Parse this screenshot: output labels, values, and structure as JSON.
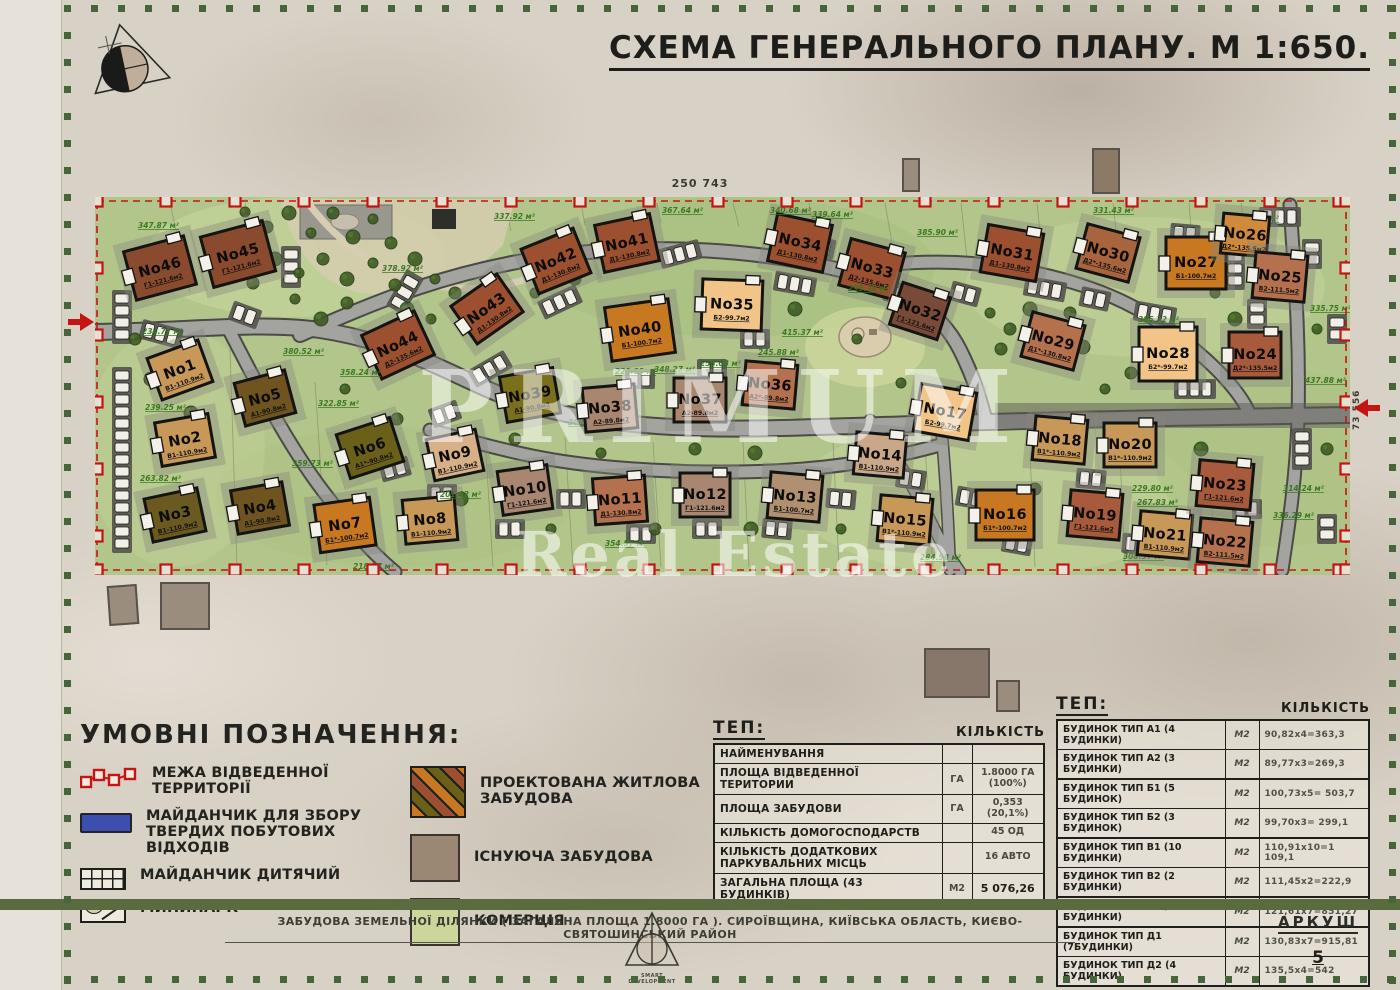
{
  "title": "СХЕМА ГЕНЕРАЛЬНОГО ПЛАНУ. М 1:650.",
  "dimensions": {
    "top": "250 743",
    "right": "73 556"
  },
  "watermark": {
    "line1": "PRIMUM",
    "line2": "Real Estate"
  },
  "legend": {
    "heading": "УМОВНІ ПОЗНАЧЕННЯ:",
    "items": [
      {
        "id": "boundary",
        "label": "МЕЖА ВІДВЕДЕННОЇ ТЕРРИТОРІЇ"
      },
      {
        "id": "waste",
        "label": "МАЙДАНЧИК ДЛЯ ЗБОРУ ТВЕРДИХ ПОБУТОВИХ ВІДХОДІВ"
      },
      {
        "id": "playground",
        "label": "МАЙДАНЧИК ДИТЯЧИЙ"
      },
      {
        "id": "minipark",
        "label": "МИНИПАРК"
      },
      {
        "id": "projected",
        "label": "ПРОЕКТОВАНА ЖИТЛОВА ЗАБУДОВА"
      },
      {
        "id": "existing",
        "label": "ІСНУЮЧА ЗАБУДОВА"
      },
      {
        "id": "commerce",
        "label": "КОМЕРЦІЯ"
      }
    ]
  },
  "tep_main": {
    "heading": "ТЕП:",
    "qty_header": "КІЛЬКІСТЬ",
    "rows": [
      {
        "name": "НАЙМЕНУВАННЯ",
        "unit": "",
        "qty": ""
      },
      {
        "name": "ПЛОЩА ВІДВЕДЕННОЇ ТЕРИТОРИИ",
        "unit": "ГА",
        "qty": "1.8000 ГА\n(100%)"
      },
      {
        "name": "ПЛОЩА ЗАБУДОВИ",
        "unit": "ГА",
        "qty": "0,353\n(20,1%)"
      },
      {
        "name": "КІЛЬКІСТЬ ДОМОГОСПОДАРСТВ",
        "unit": "",
        "qty": "45 ОД"
      },
      {
        "name": "КІЛЬКІСТЬ ДОДАТКОВИХ ПАРКУВАЛЬНИХ МІСЦЬ",
        "unit": "",
        "qty": "16 АВТО"
      },
      {
        "name": "ЗАГАЛЬНА ПЛОЩА (43 БУДИНКІВ)",
        "unit": "М2",
        "qty": "5 076,26"
      }
    ]
  },
  "tep_types": {
    "heading": "ТЕП:",
    "qty_header": "КІЛЬКІСТЬ",
    "rows": [
      {
        "name": "БУДИНОК ТИП А1 (4 БУДИНКИ)",
        "unit": "М2",
        "qty": "90,82х4=363,3",
        "grp": false
      },
      {
        "name": "БУДИНОК ТИП А2 (3 БУДИНКИ)",
        "unit": "М2",
        "qty": "89,77х3=269,3",
        "grp": true
      },
      {
        "name": "БУДИНОК ТИП Б1 (5 БУДИНОК)",
        "unit": "М2",
        "qty": "100,73х5= 503,7",
        "grp": false
      },
      {
        "name": "БУДИНОК ТИП Б2 (3 БУДИНОК)",
        "unit": "М2",
        "qty": "99,70х3= 299,1",
        "grp": true
      },
      {
        "name": "БУДИНОК ТИП В1 (10 БУДИНКИ)",
        "unit": "М2",
        "qty": "110,91х10=1 109,1",
        "grp": false
      },
      {
        "name": "БУДИНОК ТИП В2 (2 БУДИНКИ)",
        "unit": "М2",
        "qty": "111,45х2=222,9",
        "grp": true
      },
      {
        "name": "БУДИНОК ТИП Г1 (7 БУДИНКИ)",
        "unit": "М2",
        "qty": "121,61х7=851,27",
        "grp": true
      },
      {
        "name": "БУДИНОК ТИП Д1 (7БУДИНКИ)",
        "unit": "М2",
        "qty": "130,83х7=915,81",
        "grp": false
      },
      {
        "name": "БУДИНОК ТИП Д2 (4 БУДИНКИ)",
        "unit": "М2",
        "qty": "135,5х4=542",
        "grp": true
      }
    ]
  },
  "footer": {
    "project": "ЗАБУДОВА ЗЕМЕЛЬНОЇ ДІЛЯНКИ ( ЗАГАЛЬНА ПЛОЩА 1.8000 ГА ). СИРОЇВЩИНА, КИЇВСЬКА ОБЛАСТЬ, КИЄВО-СВЯТОШИНСЬКИЙ РАЙОН",
    "logo_caption": "SMART DEVELOPMENT",
    "sheet_label": "АРКУШ",
    "sheet_number": "5"
  },
  "map": {
    "boundary_color": "#c41414",
    "plots": [
      {
        "n": "No46",
        "t": "Г1-121.6м2",
        "c": "#8a4a2e",
        "x": 65,
        "y": 71,
        "w": 62,
        "h": 50,
        "r": -15,
        "a": "347.87 м²",
        "ax": -22,
        "ay": -40
      },
      {
        "n": "No45",
        "t": "Г1-121.6м2",
        "c": "#8a4a2e",
        "x": 143,
        "y": 57,
        "w": 64,
        "h": 52,
        "r": -15
      },
      {
        "n": "No44",
        "t": "Д2-135.6м2",
        "c": "#9c5030",
        "x": 303,
        "y": 148,
        "w": 58,
        "h": 48,
        "r": -25,
        "a": "358.24 м²",
        "ax": -58,
        "ay": 30
      },
      {
        "n": "No43",
        "t": "Д1-130.8м2",
        "c": "#9c5030",
        "x": 392,
        "y": 112,
        "w": 56,
        "h": 46,
        "r": -35,
        "a": "378.92 м²",
        "ax": -105,
        "ay": -38
      },
      {
        "n": "No42",
        "t": "Д1-130.8м2",
        "c": "#9c5030",
        "x": 461,
        "y": 64,
        "w": 56,
        "h": 48,
        "r": -22,
        "a": "337.92 м²",
        "ax": -62,
        "ay": -42
      },
      {
        "n": "No41",
        "t": "Д1-130.8м2",
        "c": "#9c5030",
        "x": 532,
        "y": 46,
        "w": 56,
        "h": 48,
        "r": -12,
        "a": "367.64 м²",
        "ax": 35,
        "ay": -30
      },
      {
        "n": "No40",
        "t": "Б1-100.7м2",
        "c": "#c87820",
        "x": 545,
        "y": 133,
        "w": 64,
        "h": 54,
        "r": -8,
        "a": "348.27 м²",
        "ax": 14,
        "ay": 42
      },
      {
        "n": "No35",
        "t": "Б2-99.7м2",
        "c": "#f2c488",
        "x": 637,
        "y": 108,
        "w": 60,
        "h": 50,
        "r": 2,
        "a": "415.37 м²",
        "ax": 50,
        "ay": 30
      },
      {
        "n": "No34",
        "t": "Д1-130.8м2",
        "c": "#9c5030",
        "x": 705,
        "y": 46,
        "w": 56,
        "h": 48,
        "r": 12,
        "a": "340.68 м²",
        "ax": -30,
        "ay": -30
      },
      {
        "n": "No33",
        "t": "Д2-135.6м2",
        "c": "#9c5030",
        "x": 777,
        "y": 72,
        "w": 56,
        "h": 48,
        "r": 15,
        "a": "339.64 м²",
        "ax": -60,
        "ay": -52
      },
      {
        "n": "No32",
        "t": "Г1-121.6м2",
        "c": "#7a4a38",
        "x": 825,
        "y": 114,
        "w": 50,
        "h": 44,
        "r": 18,
        "a": "295.38 м²",
        "ax": -72,
        "ay": -20
      },
      {
        "n": "No31",
        "t": "Д1-130.8м2",
        "c": "#9c5030",
        "x": 917,
        "y": 56,
        "w": 56,
        "h": 48,
        "r": 10,
        "a": "385.90 м²",
        "ax": -95,
        "ay": -18
      },
      {
        "n": "No30",
        "t": "Д2*-135.6м2",
        "c": "#a8643c",
        "x": 1013,
        "y": 56,
        "w": 54,
        "h": 46,
        "r": 15,
        "a": "331.43 м²",
        "ax": -15,
        "ay": -40
      },
      {
        "n": "No29",
        "t": "Д1*-130.8м2",
        "c": "#b5714e",
        "x": 958,
        "y": 144,
        "w": 54,
        "h": 46,
        "r": 15
      },
      {
        "n": "No28",
        "t": "Б2*-99.7м2",
        "c": "#f2c488",
        "x": 1073,
        "y": 157,
        "w": 58,
        "h": 54,
        "r": 0,
        "a": "385.72 м²",
        "ax": -30,
        "ay": -32
      },
      {
        "n": "No27",
        "t": "Б1-100.7м2",
        "c": "#c87820",
        "x": 1101,
        "y": 66,
        "w": 60,
        "h": 52,
        "r": 0,
        "a": "311.36 м²",
        "ax": 42,
        "ay": -42
      },
      {
        "n": "No26",
        "t": "Д2*-135.5м2",
        "c": "#d08a3c",
        "x": 1150,
        "y": 38,
        "w": 46,
        "h": 40,
        "r": 5
      },
      {
        "n": "No25",
        "t": "В2-111.5м2",
        "c": "#b5714e",
        "x": 1185,
        "y": 80,
        "w": 52,
        "h": 46,
        "r": 5,
        "a": "335.75 м²",
        "ax": 30,
        "ay": 34
      },
      {
        "n": "No24",
        "t": "Д2*-135.5м2",
        "c": "#a85a3c",
        "x": 1160,
        "y": 158,
        "w": 52,
        "h": 46,
        "r": 0,
        "a": "437.88 м²",
        "ax": 50,
        "ay": 28
      },
      {
        "n": "No1",
        "t": "В1-110.9м2",
        "c": "#c89858",
        "x": 85,
        "y": 173,
        "w": 54,
        "h": 44,
        "r": -20,
        "a": "234.77 м²",
        "ax": -38,
        "ay": -36
      },
      {
        "n": "No5",
        "t": "А1-90.8м2",
        "c": "#6f5420",
        "x": 170,
        "y": 201,
        "w": 52,
        "h": 44,
        "r": -15,
        "a": "380.52 м²",
        "ax": 18,
        "ay": -44
      },
      {
        "n": "No2",
        "t": "В1-110.9м2",
        "c": "#c89858",
        "x": 90,
        "y": 243,
        "w": 54,
        "h": 44,
        "r": -10,
        "a": "239.25 м²",
        "ax": -40,
        "ay": -30
      },
      {
        "n": "No6",
        "t": "А1*-90.8м2",
        "c": "#6b6018",
        "x": 275,
        "y": 251,
        "w": 56,
        "h": 46,
        "r": -18,
        "a": "322.85 м²",
        "ax": -52,
        "ay": -42
      },
      {
        "n": "No3",
        "t": "В1-110.9м2",
        "c": "#6b5a20",
        "x": 80,
        "y": 318,
        "w": 54,
        "h": 44,
        "r": -12,
        "a": "263.82 м²",
        "ax": -35,
        "ay": -34
      },
      {
        "n": "No4",
        "t": "А1-90.8м2",
        "c": "#6f5420",
        "x": 165,
        "y": 311,
        "w": 52,
        "h": 44,
        "r": -10,
        "a": "359.73 м²",
        "ax": 32,
        "ay": -42
      },
      {
        "n": "No7",
        "t": "Б1*-100.7м2",
        "c": "#c87820",
        "x": 250,
        "y": 328,
        "w": 56,
        "h": 48,
        "r": -8,
        "a": "218.77 м²",
        "ax": 8,
        "ay": 44
      },
      {
        "n": "No8",
        "t": "В1-110.9м2",
        "c": "#c89858",
        "x": 335,
        "y": 323,
        "w": 52,
        "h": 44,
        "r": -5
      },
      {
        "n": "No9",
        "t": "В1-110.9м2",
        "c": "#d8b088",
        "x": 360,
        "y": 258,
        "w": 50,
        "h": 42,
        "r": -12,
        "a": "201.42 м²",
        "ax": -15,
        "ay": 42
      },
      {
        "n": "No39",
        "t": "А1-90.8м2",
        "c": "#7a701c",
        "x": 435,
        "y": 198,
        "w": 54,
        "h": 46,
        "r": -10,
        "a": "308.90 м²",
        "ax": 38,
        "ay": 30
      },
      {
        "n": "No10",
        "t": "Г1-121.6м2",
        "c": "#a88670",
        "x": 430,
        "y": 293,
        "w": 50,
        "h": 44,
        "r": -8
      },
      {
        "n": "No38",
        "t": "А2-89.8м2",
        "c": "#a88670",
        "x": 515,
        "y": 211,
        "w": 52,
        "h": 44,
        "r": -5,
        "a": "229.83 м²",
        "ax": 5,
        "ay": -34
      },
      {
        "n": "No11",
        "t": "Д1-130.8м2",
        "c": "#b5714e",
        "x": 525,
        "y": 303,
        "w": 52,
        "h": 46,
        "r": -4,
        "a": "354.57 м²",
        "ax": -15,
        "ay": 46
      },
      {
        "n": "No37",
        "t": "А2-89.8м2",
        "c": "#a88670",
        "x": 605,
        "y": 203,
        "w": 52,
        "h": 44,
        "r": 0,
        "a": "258.03 м²",
        "ax": 0,
        "ay": -34
      },
      {
        "n": "No12",
        "t": "Г1-121.6м2",
        "c": "#a88670",
        "x": 610,
        "y": 298,
        "w": 50,
        "h": 44,
        "r": 0
      },
      {
        "n": "No36",
        "t": "А2*-89.8м2",
        "c": "#b5714e",
        "x": 675,
        "y": 188,
        "w": 52,
        "h": 44,
        "r": 5,
        "a": "245.88 м²",
        "ax": -12,
        "ay": -30
      },
      {
        "n": "No13",
        "t": "Б1-100.7м2",
        "c": "#b09070",
        "x": 700,
        "y": 300,
        "w": 52,
        "h": 46,
        "r": 5
      },
      {
        "n": "No14",
        "t": "В1-110.9м2",
        "c": "#c8a888",
        "x": 785,
        "y": 258,
        "w": 50,
        "h": 42,
        "r": 5
      },
      {
        "n": "No17",
        "t": "Б2-99.7м2",
        "c": "#f2c488",
        "x": 850,
        "y": 215,
        "w": 56,
        "h": 48,
        "r": 10
      },
      {
        "n": "No15",
        "t": "В1*-110.9м2",
        "c": "#c89858",
        "x": 810,
        "y": 323,
        "w": 52,
        "h": 46,
        "r": 5,
        "a": "284.58 м²",
        "ax": 15,
        "ay": 40
      },
      {
        "n": "No16",
        "t": "Б1*-100.7м2",
        "c": "#c87820",
        "x": 910,
        "y": 318,
        "w": 58,
        "h": 50,
        "r": 0
      },
      {
        "n": "No18",
        "t": "В1*-110.9м2",
        "c": "#c89858",
        "x": 965,
        "y": 243,
        "w": 52,
        "h": 44,
        "r": 5,
        "a": "251.05 м²",
        "ax": 48,
        "ay": 8
      },
      {
        "n": "No19",
        "t": "Г1-121.6м2",
        "c": "#a85a3c",
        "x": 1000,
        "y": 318,
        "w": 52,
        "h": 46,
        "r": 5,
        "a": "308.37 м²",
        "ax": 28,
        "ay": 44
      },
      {
        "n": "No20",
        "t": "В1*-110.9м2",
        "c": "#c89858",
        "x": 1035,
        "y": 248,
        "w": 52,
        "h": 44,
        "r": 0,
        "a": "229.80 м²",
        "ax": 2,
        "ay": 46
      },
      {
        "n": "No21",
        "t": "В1-110.9м2",
        "c": "#c89858",
        "x": 1070,
        "y": 338,
        "w": 52,
        "h": 44,
        "r": 5,
        "a": "267.83 м²",
        "ax": -28,
        "ay": -30
      },
      {
        "n": "No23",
        "t": "Г1-121.6м2",
        "c": "#a85a3c",
        "x": 1130,
        "y": 288,
        "w": 54,
        "h": 46,
        "r": 5,
        "a": "314.24 м²",
        "ax": 58,
        "ay": 6
      },
      {
        "n": "No22",
        "t": "В2-111.5м2",
        "c": "#b5714e",
        "x": 1130,
        "y": 345,
        "w": 52,
        "h": 44,
        "r": 5,
        "a": "336.29 м²",
        "ax": 48,
        "ay": -24
      }
    ]
  }
}
